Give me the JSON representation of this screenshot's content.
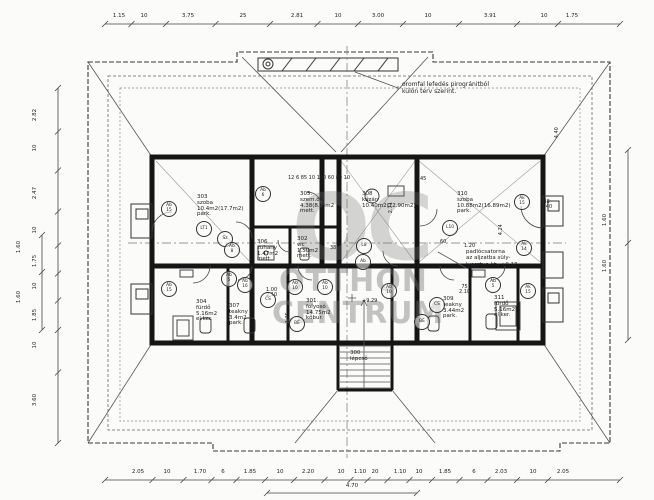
{
  "watermark": {
    "logo": "OC",
    "line1": "OTTHON",
    "line2": "CENTRUM"
  },
  "notes": {
    "roof_1": "oromfal lefedés pirogránitból",
    "roof_2": "külön terv szerint.",
    "ch_1": "padlócsatorna",
    "ch_2": "az aljzatba süly-",
    "ch_3": "lyesztve kb: +9.18"
  },
  "rooms": [
    {
      "x": 197,
      "y": 195,
      "lines": [
        "303",
        "szoba",
        "10.4m2(17.7m2)",
        "park."
      ]
    },
    {
      "x": 300,
      "y": 192,
      "lines": [
        "305.",
        "szem.ölt.",
        "4.38(8.4)m2",
        "mett."
      ]
    },
    {
      "x": 362,
      "y": 192,
      "lines": [
        "308",
        "kazán",
        "10.40m2(12.90m2)"
      ]
    },
    {
      "x": 457,
      "y": 192,
      "lines": [
        "310",
        "szoba",
        "10.88m2(16.89m2)",
        "park."
      ]
    },
    {
      "x": 257,
      "y": 240,
      "lines": [
        "306",
        "zuhany",
        "1.47m2",
        "mett."
      ]
    },
    {
      "x": 297,
      "y": 237,
      "lines": [
        "302",
        "wc",
        "1.50m2",
        "mett."
      ]
    },
    {
      "x": 196,
      "y": 300,
      "lines": [
        "304",
        "fürdő",
        "5.16m2",
        "el.ker."
      ]
    },
    {
      "x": 229,
      "y": 304,
      "lines": [
        "307",
        "teakny",
        "3.4m2",
        "park."
      ]
    },
    {
      "x": 306,
      "y": 299,
      "lines": [
        "301.",
        "folyosó",
        "14.75m2",
        "kőbur."
      ]
    },
    {
      "x": 443,
      "y": 297,
      "lines": [
        "309",
        "teakny",
        "3.44m2",
        "park."
      ]
    },
    {
      "x": 494,
      "y": 296,
      "lines": [
        "311",
        "fürdő",
        "5.16m2",
        "el.ker."
      ]
    },
    {
      "x": 350,
      "y": 351,
      "lines": [
        "300",
        "lépcső"
      ]
    }
  ],
  "fixtures": [
    {
      "x": 168,
      "y": 208,
      "lines": [
        "Ab",
        "15"
      ]
    },
    {
      "x": 168,
      "y": 288,
      "lines": [
        "Ab",
        "15"
      ]
    },
    {
      "x": 224,
      "y": 238,
      "lines": [
        "Sz"
      ]
    },
    {
      "x": 203,
      "y": 228,
      "lines": [
        "LT1"
      ]
    },
    {
      "x": 231,
      "y": 249,
      "lines": [
        "Ab",
        "8"
      ]
    },
    {
      "x": 262,
      "y": 193,
      "lines": [
        "Ab",
        "6"
      ]
    },
    {
      "x": 363,
      "y": 245,
      "lines": [
        "L8"
      ]
    },
    {
      "x": 362,
      "y": 261,
      "lines": [
        "Ab"
      ]
    },
    {
      "x": 449,
      "y": 227,
      "lines": [
        "L10"
      ]
    },
    {
      "x": 521,
      "y": 201,
      "lines": [
        "Ak",
        "15"
      ]
    },
    {
      "x": 523,
      "y": 247,
      "lines": [
        "Ak",
        "14"
      ]
    },
    {
      "x": 294,
      "y": 286,
      "lines": [
        "Ab",
        "10"
      ]
    },
    {
      "x": 324,
      "y": 286,
      "lines": [
        "Ab",
        "10"
      ]
    },
    {
      "x": 388,
      "y": 290,
      "lines": [
        "Ab",
        "10"
      ]
    },
    {
      "x": 228,
      "y": 278,
      "lines": [
        "Ab",
        "5"
      ]
    },
    {
      "x": 244,
      "y": 284,
      "lines": [
        "Ab",
        "16"
      ]
    },
    {
      "x": 267,
      "y": 299,
      "lines": [
        "CS"
      ]
    },
    {
      "x": 296,
      "y": 323,
      "lines": [
        "BÉ"
      ]
    },
    {
      "x": 436,
      "y": 304,
      "lines": [
        "CS"
      ]
    },
    {
      "x": 421,
      "y": 321,
      "lines": [
        "BÉ"
      ]
    },
    {
      "x": 492,
      "y": 284,
      "lines": [
        "Ab",
        "5"
      ]
    },
    {
      "x": 527,
      "y": 290,
      "lines": [
        "Ak",
        "15"
      ]
    }
  ],
  "dims": {
    "top": [
      {
        "t": "1.15",
        "x": 119
      },
      {
        "t": "10",
        "x": 144
      },
      {
        "t": "3.75",
        "x": 188
      },
      {
        "t": "25",
        "x": 243
      },
      {
        "t": "2.81",
        "x": 297
      },
      {
        "t": "10",
        "x": 338
      },
      {
        "t": "3.00",
        "x": 378
      },
      {
        "t": "10",
        "x": 428
      },
      {
        "t": "3.91",
        "x": 490
      },
      {
        "t": "10",
        "x": 544
      },
      {
        "t": "1.75",
        "x": 572
      }
    ],
    "bottom": [
      {
        "t": "2.05",
        "x": 138
      },
      {
        "t": "10",
        "x": 167
      },
      {
        "t": "1.70",
        "x": 200
      },
      {
        "t": "6",
        "x": 223
      },
      {
        "t": "1.85",
        "x": 250
      },
      {
        "t": "10",
        "x": 280
      },
      {
        "t": "2.20",
        "x": 308
      },
      {
        "t": "10",
        "x": 341
      },
      {
        "t": "1.10",
        "x": 360
      },
      {
        "t": "20",
        "x": 375
      },
      {
        "t": "1.10",
        "x": 400
      },
      {
        "t": "10",
        "x": 419
      },
      {
        "t": "1.85",
        "x": 445
      },
      {
        "t": "6",
        "x": 474
      },
      {
        "t": "2.03",
        "x": 501
      },
      {
        "t": "10",
        "x": 533
      },
      {
        "t": "2.05",
        "x": 563
      }
    ],
    "bottom_span": [
      {
        "t": "4.70",
        "x": 352
      }
    ],
    "left": [
      {
        "t": "2.82",
        "y": 115
      },
      {
        "t": "10",
        "y": 148
      },
      {
        "t": "2.47",
        "y": 193
      },
      {
        "t": "10",
        "y": 230
      },
      {
        "t": "1.75",
        "y": 261
      },
      {
        "t": "10",
        "y": 286
      },
      {
        "t": "1.85",
        "y": 315
      },
      {
        "t": "10",
        "y": 345
      },
      {
        "t": "3.60",
        "y": 400
      }
    ],
    "left_inner": [
      {
        "t": "1.60",
        "y": 247
      },
      {
        "t": "1.60",
        "y": 297
      }
    ],
    "right": [
      {
        "t": "1.60",
        "y": 220
      },
      {
        "t": "1.60",
        "y": 266
      }
    ],
    "inner": [
      {
        "t": "12 6 85 10 100 60 80 10",
        "x": 288,
        "y": 176
      },
      {
        "t": "45",
        "x": 420,
        "y": 177
      },
      {
        "t": "2.71",
        "x": 386,
        "y": 205,
        "rot": 1
      },
      {
        "t": "4.24",
        "x": 496,
        "y": 227,
        "rot": 1
      },
      {
        "t": "4.40",
        "x": 552,
        "y": 130,
        "rot": 1
      },
      {
        "t": "+9.29",
        "x": 362,
        "y": 299
      },
      {
        "t": "60",
        "x": 440,
        "y": 240
      },
      {
        "t": "1.20",
        "x": 464,
        "y": 244
      },
      {
        "t": "38",
        "x": 330,
        "y": 246
      },
      {
        "t": "1.00|2.10",
        "x": 266,
        "y": 288
      },
      {
        "t": "75|2.10",
        "x": 459,
        "y": 285
      },
      {
        "t": "38|1.40",
        "x": 541,
        "y": 200
      },
      {
        "t": "1.25",
        "x": 283,
        "y": 315,
        "rot": 1
      }
    ]
  }
}
